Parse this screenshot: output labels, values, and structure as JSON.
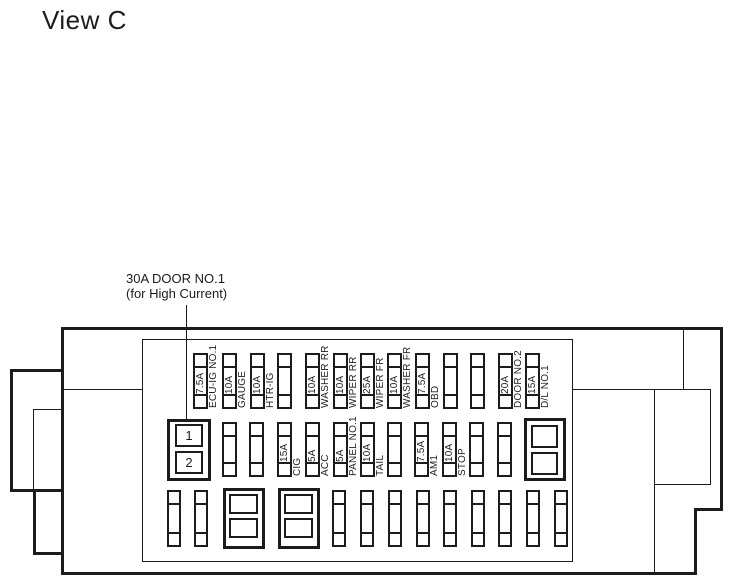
{
  "title": "View C",
  "callout": {
    "line1": "30A DOOR NO.1",
    "line2": "(for High Current)"
  },
  "colors": {
    "line": "#1c1c1c",
    "background": "#ffffff"
  },
  "fusebox": {
    "top_row": [
      {
        "amp": "7.5A",
        "name": "ECU-IG NO.1"
      },
      {
        "amp": "10A",
        "name": "GAUGE"
      },
      {
        "amp": "10A",
        "name": "HTR-IG"
      },
      {
        "amp": "",
        "name": ""
      },
      {
        "amp": "10A",
        "name": "WASHER RR"
      },
      {
        "amp": "10A",
        "name": "WIPER RR"
      },
      {
        "amp": "25A",
        "name": "WIPER FR"
      },
      {
        "amp": "10A",
        "name": "WASHER FR"
      },
      {
        "amp": "7.5A",
        "name": "OBD"
      },
      {
        "amp": "",
        "name": ""
      },
      {
        "amp": "",
        "name": ""
      },
      {
        "amp": "20A",
        "name": "DOOR NO.2"
      },
      {
        "amp": "15A",
        "name": "D/L NO.1"
      }
    ],
    "middle_row": {
      "door_connector_terminals": [
        "1",
        "2"
      ],
      "fuses": [
        {
          "amp": "",
          "name": ""
        },
        {
          "amp": "",
          "name": ""
        },
        {
          "amp": "15A",
          "name": "CIG"
        },
        {
          "amp": "5A",
          "name": "ACC"
        },
        {
          "amp": "5A",
          "name": "PANEL NO.1"
        },
        {
          "amp": "10A",
          "name": "TAIL"
        },
        {
          "amp": "",
          "name": ""
        },
        {
          "amp": "7.5A",
          "name": "AM1"
        },
        {
          "amp": "10A",
          "name": "STOP"
        },
        {
          "amp": "",
          "name": ""
        },
        {
          "amp": "",
          "name": ""
        }
      ]
    }
  }
}
